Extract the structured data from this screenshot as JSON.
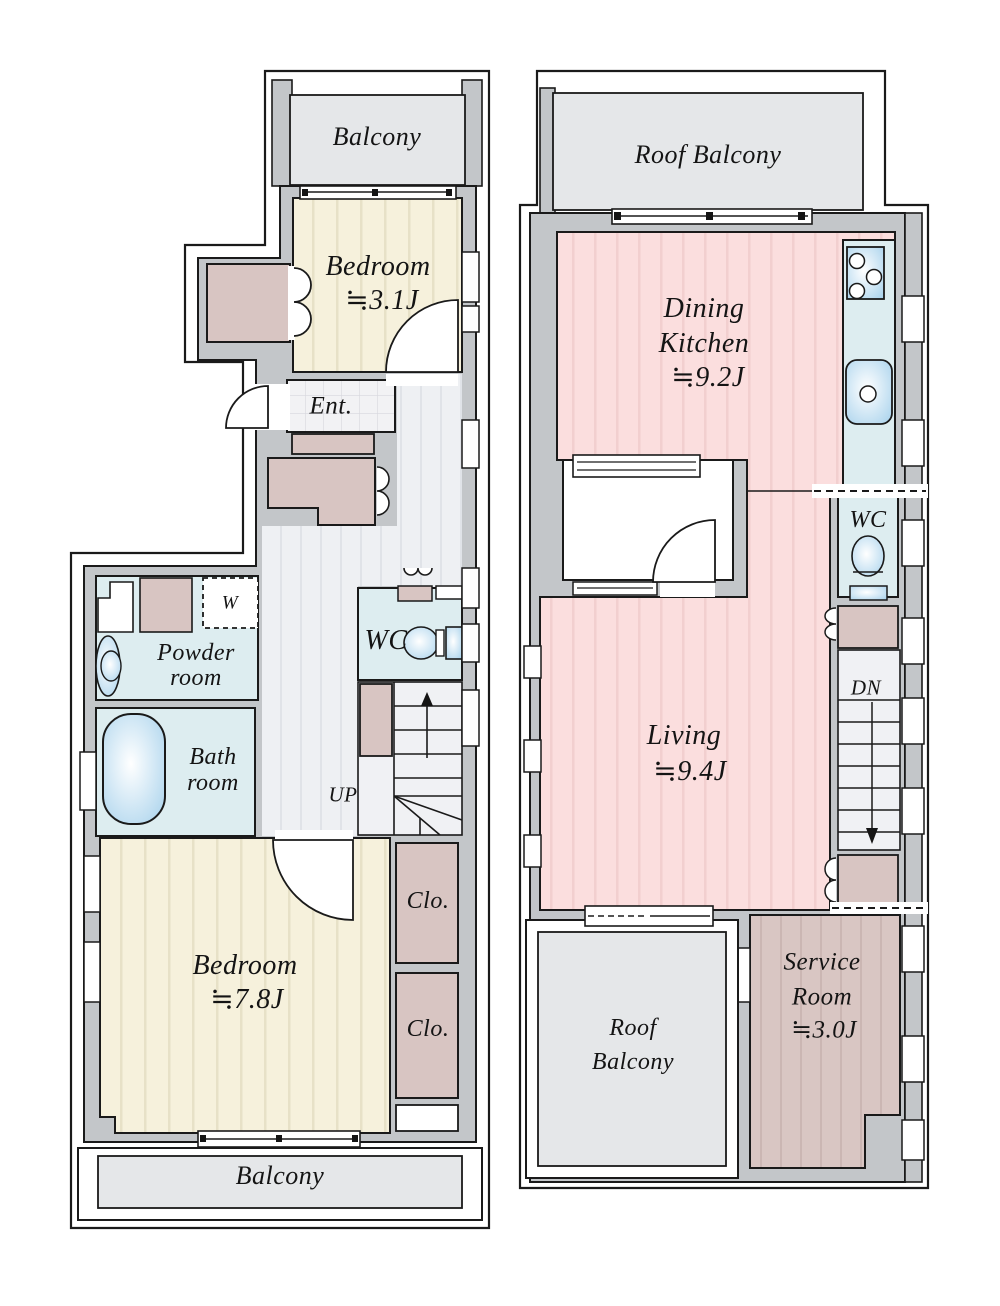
{
  "palette": {
    "wall": "#c3c6c9",
    "outline": "#1a1a1a",
    "balcony": "#e5e7e9",
    "cream": "#f6f1dc",
    "creamStripe": "#e7e1c7",
    "pink": "#fbdede",
    "pinkStripe": "#f2cfcf",
    "hall": "#eef0f3",
    "hallStripe": "#e0e3e8",
    "cyan": "#ddedf0",
    "closet": "#d8c5c2",
    "service": "#d9c6c3",
    "serviceStripe": "#cbb6b3",
    "tile": "#f2f2f4",
    "fixture": "#a8d2ec"
  },
  "left_plan": {
    "balcony_top": "Balcony",
    "bedroom_small": {
      "name": "Bedroom",
      "area": "≒3.1J"
    },
    "entrance": "Ent.",
    "washer": "W",
    "powder_room": {
      "line1": "Powder",
      "line2": "room"
    },
    "wc": "WC",
    "bath_room": {
      "line1": "Bath",
      "line2": "room"
    },
    "stairs_up": "UP",
    "bedroom_large": {
      "name": "Bedroom",
      "area": "≒7.8J"
    },
    "closet_upper": "Clo.",
    "closet_lower": "Clo.",
    "balcony_bottom": "Balcony"
  },
  "right_plan": {
    "roof_balcony_top": "Roof Balcony",
    "dining_kitchen": {
      "line1": "Dining",
      "line2": "Kitchen",
      "area": "≒9.2J"
    },
    "wc": "WC",
    "living": {
      "name": "Living",
      "area": "≒9.4J"
    },
    "stairs_down": "DN",
    "roof_balcony_bottom": {
      "line1": "Roof",
      "line2": "Balcony"
    },
    "service_room": {
      "line1": "Service",
      "line2": "Room",
      "area": "≒3.0J"
    }
  }
}
